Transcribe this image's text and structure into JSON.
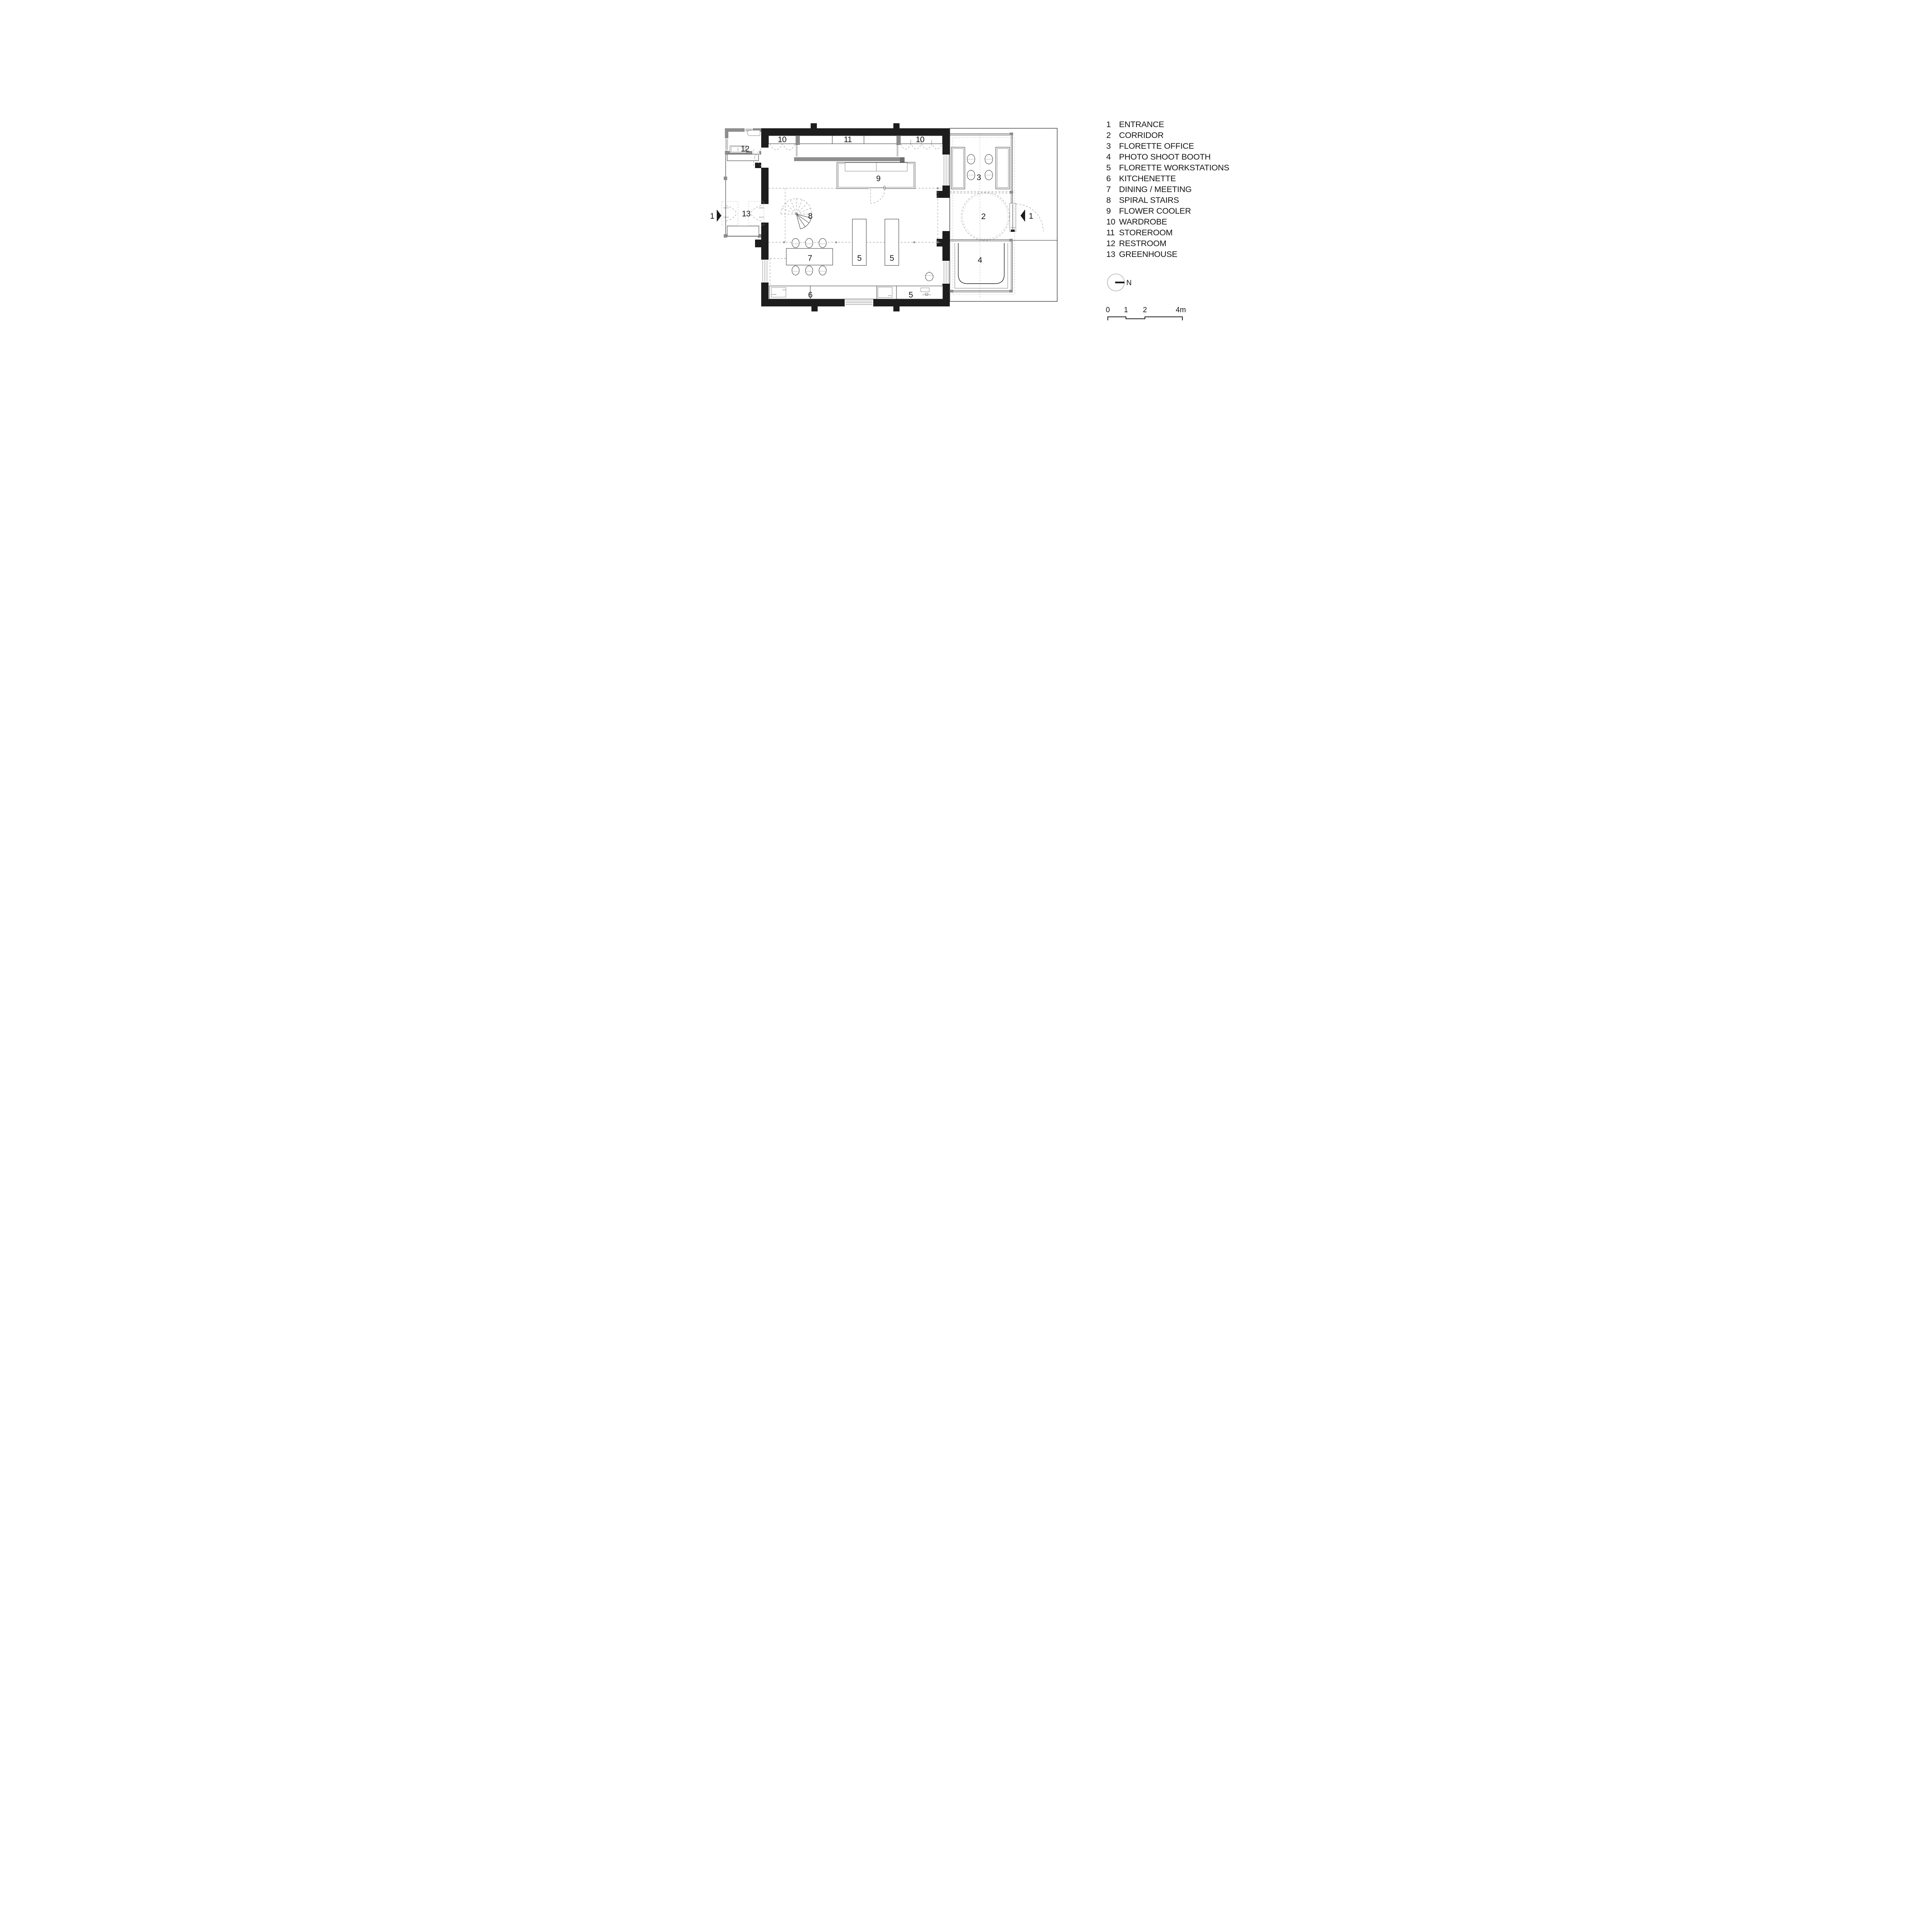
{
  "legend": {
    "items": [
      {
        "num": "1",
        "label": "ENTRANCE"
      },
      {
        "num": "2",
        "label": "CORRIDOR"
      },
      {
        "num": "3",
        "label": "FLORETTE OFFICE"
      },
      {
        "num": "4",
        "label": "PHOTO SHOOT BOOTH"
      },
      {
        "num": "5",
        "label": "FLORETTE WORKSTATIONS"
      },
      {
        "num": "6",
        "label": "KITCHENETTE"
      },
      {
        "num": "7",
        "label": "DINING / MEETING"
      },
      {
        "num": "8",
        "label": "SPIRAL STAIRS"
      },
      {
        "num": "9",
        "label": "FLOWER COOLER"
      },
      {
        "num": "10",
        "label": "WARDROBE"
      },
      {
        "num": "11",
        "label": "STOREROOM"
      },
      {
        "num": "12",
        "label": "RESTROOM"
      },
      {
        "num": "13",
        "label": "GREENHOUSE"
      }
    ]
  },
  "plan": {
    "room_labels": [
      {
        "room": "wardrobe-left",
        "text": "10"
      },
      {
        "room": "storeroom",
        "text": "11"
      },
      {
        "room": "wardrobe-right",
        "text": "10"
      },
      {
        "room": "restroom",
        "text": "12"
      },
      {
        "room": "flower-cooler",
        "text": "9"
      },
      {
        "room": "greenhouse",
        "text": "13"
      },
      {
        "room": "spiral-stairs",
        "text": "8"
      },
      {
        "room": "corridor",
        "text": "2"
      },
      {
        "room": "florette-office",
        "text": "3"
      },
      {
        "room": "photo-shoot-booth",
        "text": "4"
      },
      {
        "room": "dining-meeting",
        "text": "7"
      },
      {
        "room": "workstation-a",
        "text": "5"
      },
      {
        "room": "workstation-b",
        "text": "5"
      },
      {
        "room": "kitchenette",
        "text": "6"
      },
      {
        "room": "workstation-counter",
        "text": "5"
      },
      {
        "room": "section-marker-left",
        "text": "1"
      },
      {
        "room": "section-marker-right",
        "text": "1"
      }
    ]
  },
  "north": {
    "label": "N"
  },
  "scale_bar": {
    "ticks": [
      "0",
      "1",
      "2",
      "4m"
    ]
  },
  "colors": {
    "wall": "#1d1d1d",
    "interior_gray_wall": "#8e8e8e",
    "dashed_guides": "#8c8c8c",
    "background": "#ffffff"
  }
}
